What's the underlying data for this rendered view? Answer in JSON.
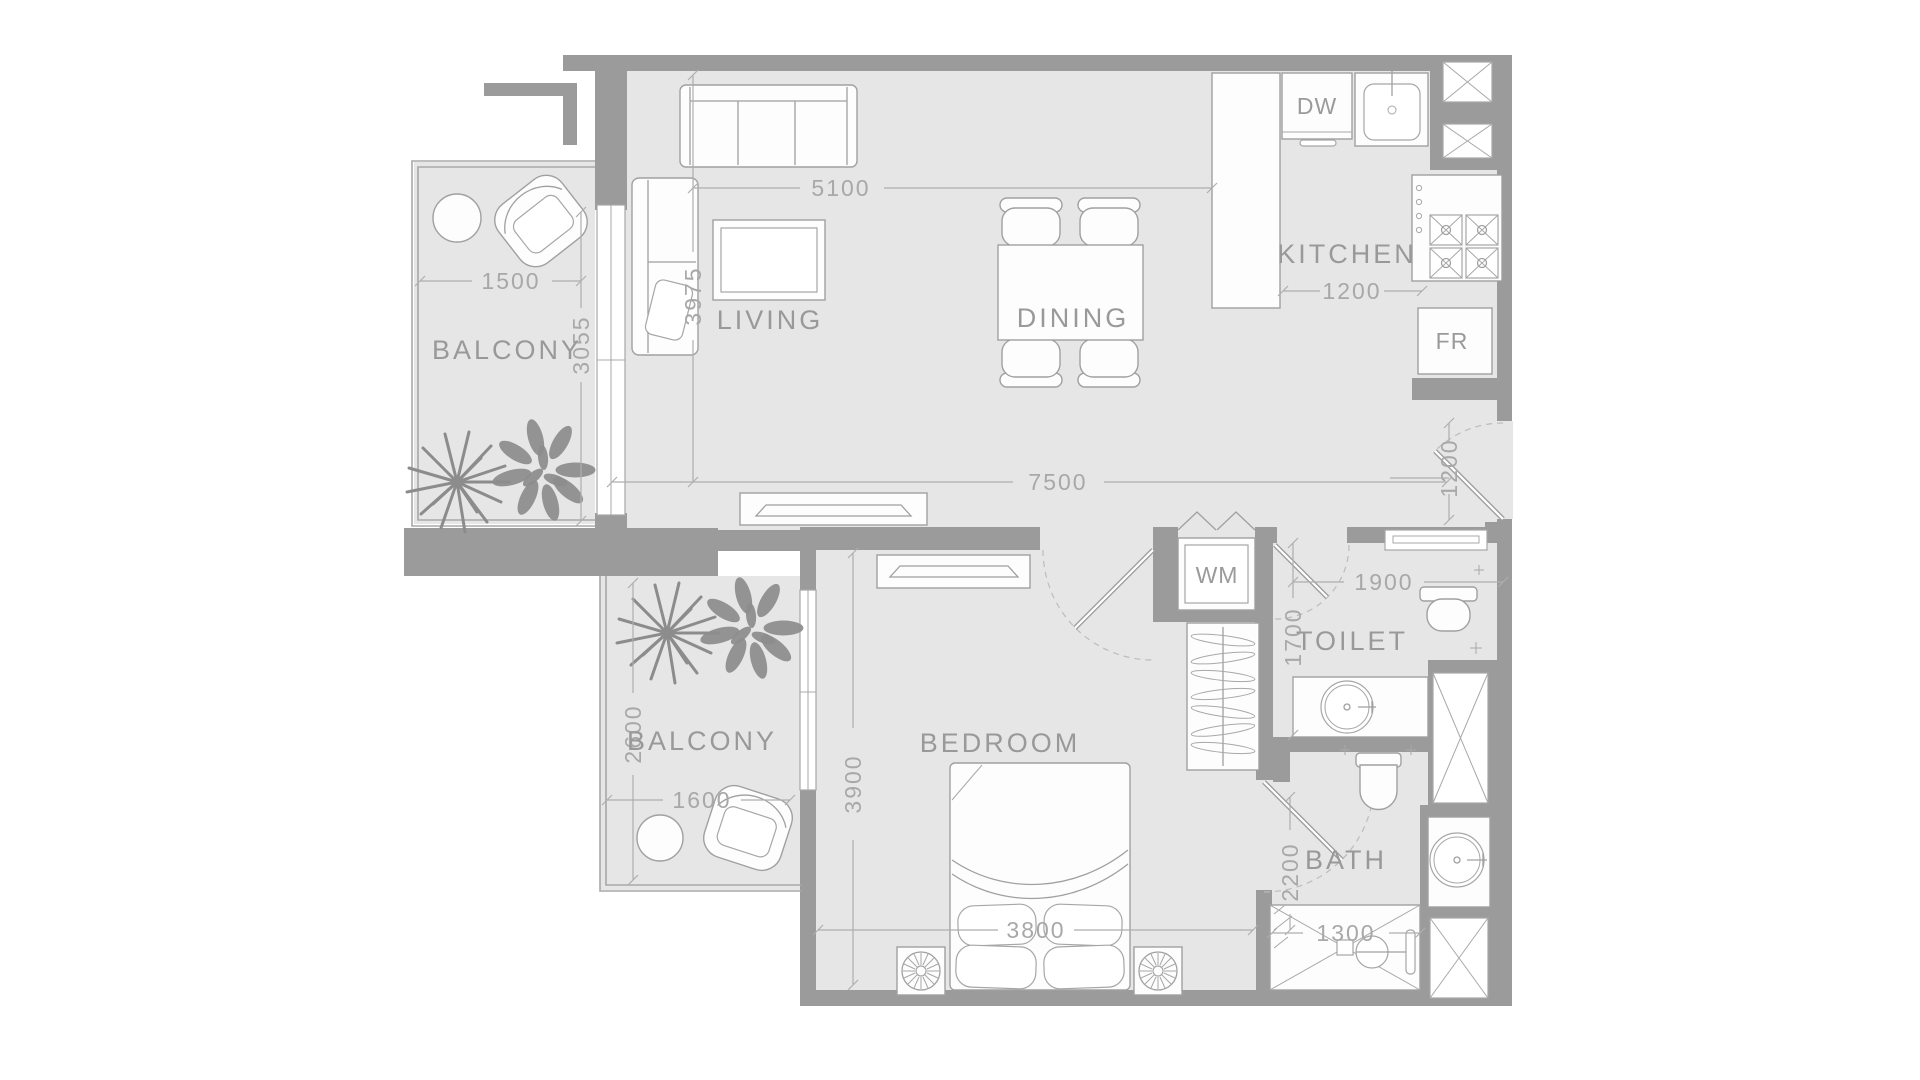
{
  "title": "One-bedroom apartment floor plan",
  "colors": {
    "background": "#ffffff",
    "floor": "#e6e6e6",
    "wall": "#9b9b9b",
    "furniture_line": "#a0a0a0",
    "label_text": "#999999",
    "dimension_text": "#a8a8a8",
    "plant": "#8c8c8c"
  },
  "rooms": {
    "living": {
      "label": "LIVING",
      "width_mm": "5100",
      "depth_mm": "3975"
    },
    "dining": {
      "label": "DINING"
    },
    "kitchen": {
      "label": "KITCHEN",
      "counter_depth_mm": "1200"
    },
    "bedroom": {
      "label": "BEDROOM",
      "depth_mm": "3900",
      "bed_width_mm": "3800"
    },
    "toilet": {
      "label": "TOILET",
      "width_mm": "1900",
      "depth_mm": "1700"
    },
    "bath": {
      "label": "BATH",
      "depth_mm": "2200",
      "shower_width_mm": "1300"
    },
    "balcony_upper": {
      "label": "BALCONY",
      "width_mm": "1500",
      "depth_mm": "3055"
    },
    "balcony_lower": {
      "label": "BALCONY",
      "width_mm": "1600",
      "depth_mm": "2600"
    }
  },
  "overall": {
    "living_total_width_mm": "7500",
    "entry_door_mm": "1200"
  },
  "appliances": {
    "dishwasher": "DW",
    "fridge": "FR",
    "washing_machine": "WM"
  }
}
